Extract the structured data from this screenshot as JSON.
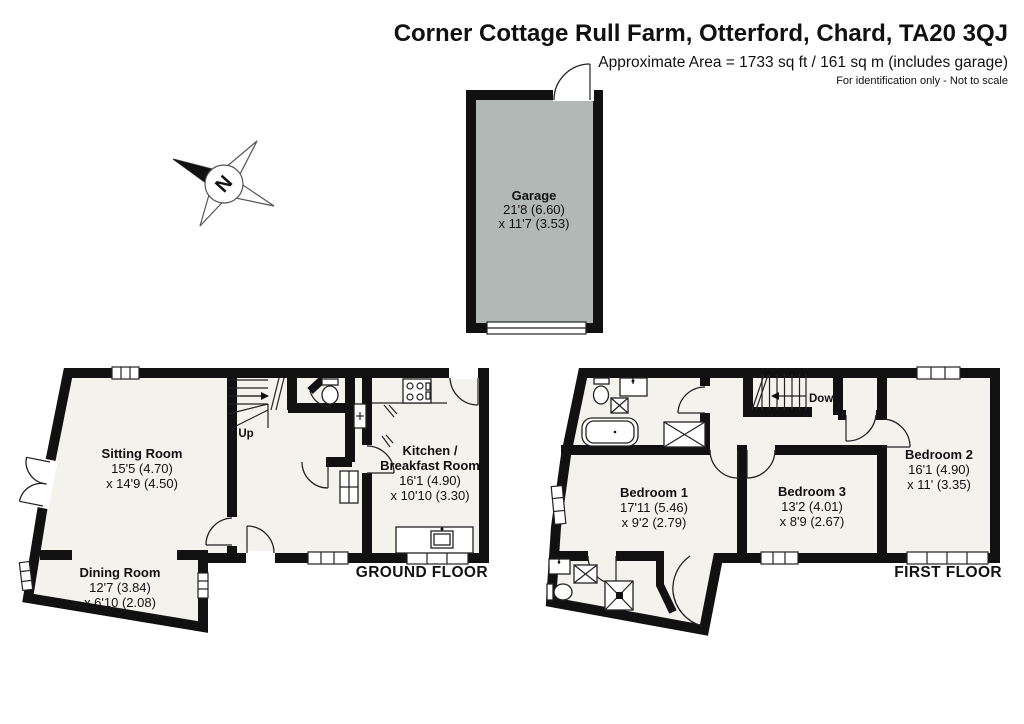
{
  "header": {
    "title": "Corner Cottage Rull Farm, Otterford, Chard, TA20 3QJ",
    "subtitle": "Approximate Area = 1733 sq ft / 161 sq m (includes garage)",
    "disclaimer": "For identification only - Not to scale"
  },
  "compass": {
    "label": "N"
  },
  "garage": {
    "name": "Garage",
    "dim1": "21'8 (6.60)",
    "dim2": "x 11'7 (3.53)"
  },
  "ground_floor": {
    "label": "GROUND FLOOR",
    "stairs_label": "Up",
    "sitting_room": {
      "name": "Sitting Room",
      "dim1": "15'5 (4.70)",
      "dim2": "x 14'9 (4.50)"
    },
    "dining_room": {
      "name": "Dining Room",
      "dim1": "12'7 (3.84)",
      "dim2": "x 6'10 (2.08)"
    },
    "kitchen": {
      "name_line1": "Kitchen /",
      "name_line2": "Breakfast Room",
      "dim1": "16'1 (4.90)",
      "dim2": "x 10'10 (3.30)"
    }
  },
  "first_floor": {
    "label": "FIRST FLOOR",
    "stairs_label": "Down",
    "bedroom1": {
      "name": "Bedroom 1",
      "dim1": "17'11 (5.46)",
      "dim2": "x 9'2 (2.79)"
    },
    "bedroom2": {
      "name": "Bedroom 2",
      "dim1": "16'1 (4.90)",
      "dim2": "x 11' (3.35)"
    },
    "bedroom3": {
      "name": "Bedroom 3",
      "dim1": "13'2 (4.01)",
      "dim2": "x 8'9 (2.67)"
    }
  },
  "colors": {
    "wall": "#111111",
    "room_fill": "#f3f2ed",
    "garage_fill": "#b2b8b5",
    "background": "#ffffff"
  }
}
